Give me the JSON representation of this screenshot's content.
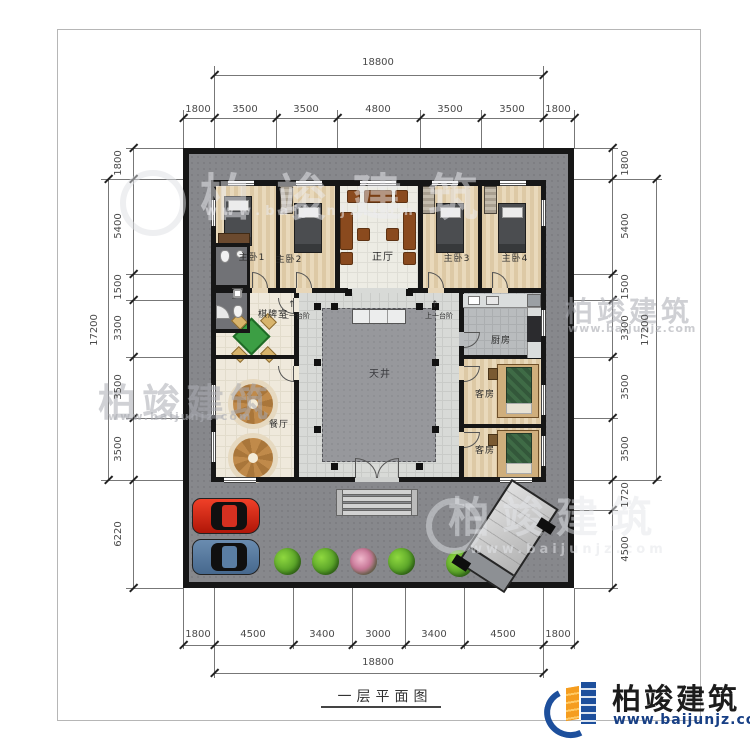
{
  "plan": {
    "title": "一层平面图",
    "rooms": {
      "master1": "主卧1",
      "master2": "主卧2",
      "hall": "正厅",
      "master3": "主卧3",
      "master4": "主卧4",
      "chess": "棋牌室",
      "dining": "餐厅",
      "kitchen": "厨房",
      "guest1": "客房",
      "guest2": "客房",
      "courtyard": "天井"
    },
    "annotations": {
      "step_left": "上一台阶",
      "step_right": "上一台阶",
      "arrow_up": "↑"
    }
  },
  "dimensions": {
    "top": {
      "total": "18800",
      "segments": [
        "1800",
        "3500",
        "3500",
        "4800",
        "3500",
        "3500",
        "1800"
      ]
    },
    "bottom": {
      "total": "18800",
      "segments": [
        "1800",
        "4500",
        "3400",
        "3000",
        "3400",
        "4500",
        "1800"
      ]
    },
    "left": {
      "total": "17200",
      "segments": [
        "1800",
        "5400",
        "1500",
        "3300",
        "3500",
        "3500",
        "6220"
      ]
    },
    "right": {
      "total": "17200",
      "segments": [
        "1800",
        "5400",
        "1500",
        "3300",
        "3500",
        "3500",
        "1720",
        "4500"
      ]
    }
  },
  "branding": {
    "logo_name": "柏竣建筑",
    "logo_url": "www.baijunjz.com",
    "watermark_name": "柏竣建筑",
    "watermark_url": "www.baijunjz.com"
  },
  "colors": {
    "logo_blue": "#1d4f9c",
    "logo_orange": "#f59d1f",
    "wall_black": "#161616",
    "compound_gray": "#87888c",
    "courtyard_gray": "#96979b",
    "table_green": "#3c9e44",
    "car_red": "#d22a18",
    "car_blue": "#5b80a8"
  }
}
